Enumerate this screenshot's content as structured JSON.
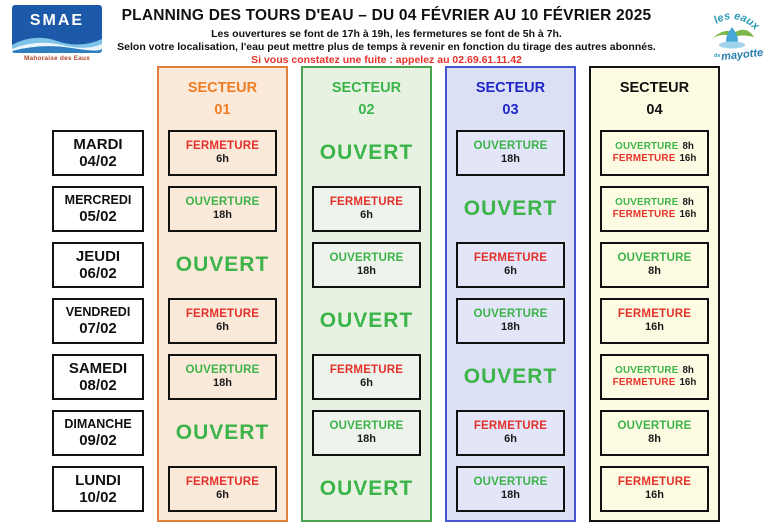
{
  "header": {
    "title": "PLANNING DES TOURS D'EAU – DU 04 FÉVRIER AU 10 FÉVRIER 2025",
    "subtitle1": "Les ouvertures se font de 17h à 19h, les fermetures se font de 5h à 7h.",
    "subtitle2": "Selon votre localisation, l'eau peut mettre plus de temps à revenir en fonction du tirage des autres abonnés.",
    "alert": "Si vous constatez une fuite : appelez au 02.69.61.11.42",
    "logo_left": {
      "name": "SMAE",
      "caption": "Mahoraise des Eaux"
    },
    "logo_right": {
      "line1": "les eaux",
      "line2": "de",
      "line3": "mayotte"
    }
  },
  "colors": {
    "open_green": "#3cb44a",
    "closed_red": "#e5312b",
    "time_black": "#1a1a1a",
    "alert_red": "#e5312b",
    "day_border": "#111111"
  },
  "days": [
    {
      "name": "MARDI",
      "date": "04/02"
    },
    {
      "name": "MERCREDI",
      "date": "05/02"
    },
    {
      "name": "JEUDI",
      "date": "06/02"
    },
    {
      "name": "VENDREDI",
      "date": "07/02"
    },
    {
      "name": "SAMEDI",
      "date": "08/02"
    },
    {
      "name": "DIMANCHE",
      "date": "09/02"
    },
    {
      "name": "LUNDI",
      "date": "10/02"
    }
  ],
  "sectors": [
    {
      "label": "SECTEUR",
      "number": "01",
      "colors": {
        "border": "#e0803c",
        "bg": "#fbe9d9",
        "box_bg": "#fbe9d9",
        "title": "#ee7d25"
      },
      "cells": [
        {
          "style": "box",
          "lines": [
            {
              "word": "FERMETURE",
              "state": "closed",
              "time": "6h"
            }
          ]
        },
        {
          "style": "box",
          "lines": [
            {
              "word": "OUVERTURE",
              "state": "open",
              "time": "18h"
            }
          ]
        },
        {
          "style": "open",
          "label": "OUVERT"
        },
        {
          "style": "box",
          "lines": [
            {
              "word": "FERMETURE",
              "state": "closed",
              "time": "6h"
            }
          ]
        },
        {
          "style": "box",
          "lines": [
            {
              "word": "OUVERTURE",
              "state": "open",
              "time": "18h"
            }
          ]
        },
        {
          "style": "open",
          "label": "OUVERT"
        },
        {
          "style": "box",
          "lines": [
            {
              "word": "FERMETURE",
              "state": "closed",
              "time": "6h"
            }
          ]
        }
      ]
    },
    {
      "label": "SECTEUR",
      "number": "02",
      "colors": {
        "border": "#4aa34e",
        "bg": "#e7f2e2",
        "box_bg": "#eef3ec",
        "title": "#3cb44a"
      },
      "cells": [
        {
          "style": "open",
          "label": "OUVERT"
        },
        {
          "style": "box",
          "lines": [
            {
              "word": "FERMETURE",
              "state": "closed",
              "time": "6h"
            }
          ]
        },
        {
          "style": "box",
          "lines": [
            {
              "word": "OUVERTURE",
              "state": "open",
              "time": "18h"
            }
          ]
        },
        {
          "style": "open",
          "label": "OUVERT"
        },
        {
          "style": "box",
          "lines": [
            {
              "word": "FERMETURE",
              "state": "closed",
              "time": "6h"
            }
          ]
        },
        {
          "style": "box",
          "lines": [
            {
              "word": "OUVERTURE",
              "state": "open",
              "time": "18h"
            }
          ]
        },
        {
          "style": "open",
          "label": "OUVERT"
        }
      ]
    },
    {
      "label": "SECTEUR",
      "number": "03",
      "colors": {
        "border": "#4656cf",
        "bg": "#dbe0f5",
        "box_bg": "#e2e6f8",
        "title": "#2026c8"
      },
      "cells": [
        {
          "style": "box",
          "lines": [
            {
              "word": "OUVERTURE",
              "state": "open",
              "time": "18h"
            }
          ]
        },
        {
          "style": "open",
          "label": "OUVERT"
        },
        {
          "style": "box",
          "lines": [
            {
              "word": "FERMETURE",
              "state": "closed",
              "time": "6h"
            }
          ]
        },
        {
          "style": "box",
          "lines": [
            {
              "word": "OUVERTURE",
              "state": "open",
              "time": "18h"
            }
          ]
        },
        {
          "style": "open",
          "label": "OUVERT"
        },
        {
          "style": "box",
          "lines": [
            {
              "word": "FERMETURE",
              "state": "closed",
              "time": "6h"
            }
          ]
        },
        {
          "style": "box",
          "lines": [
            {
              "word": "OUVERTURE",
              "state": "open",
              "time": "18h"
            }
          ]
        }
      ]
    },
    {
      "label": "SECTEUR",
      "number": "04",
      "colors": {
        "border": "#141414",
        "bg": "#fdfce3",
        "box_bg": "#fdfce3",
        "title": "#111111"
      },
      "cells": [
        {
          "style": "box",
          "inline": true,
          "lines": [
            {
              "word": "OUVERTURE",
              "state": "open",
              "time": "8h"
            },
            {
              "word": "FERMETURE",
              "state": "closed",
              "time": "16h"
            }
          ]
        },
        {
          "style": "box",
          "inline": true,
          "lines": [
            {
              "word": "OUVERTURE",
              "state": "open",
              "time": "8h"
            },
            {
              "word": "FERMETURE",
              "state": "closed",
              "time": "16h"
            }
          ]
        },
        {
          "style": "box",
          "lines": [
            {
              "word": "OUVERTURE",
              "state": "open",
              "time": "8h"
            }
          ]
        },
        {
          "style": "box",
          "lines": [
            {
              "word": "FERMETURE",
              "state": "closed",
              "time": "16h"
            }
          ]
        },
        {
          "style": "box",
          "inline": true,
          "lines": [
            {
              "word": "OUVERTURE",
              "state": "open",
              "time": "8h"
            },
            {
              "word": "FERMETURE",
              "state": "closed",
              "time": "16h"
            }
          ]
        },
        {
          "style": "box",
          "lines": [
            {
              "word": "OUVERTURE",
              "state": "open",
              "time": "8h"
            }
          ]
        },
        {
          "style": "box",
          "lines": [
            {
              "word": "FERMETURE",
              "state": "closed",
              "time": "16h"
            }
          ]
        }
      ]
    }
  ]
}
